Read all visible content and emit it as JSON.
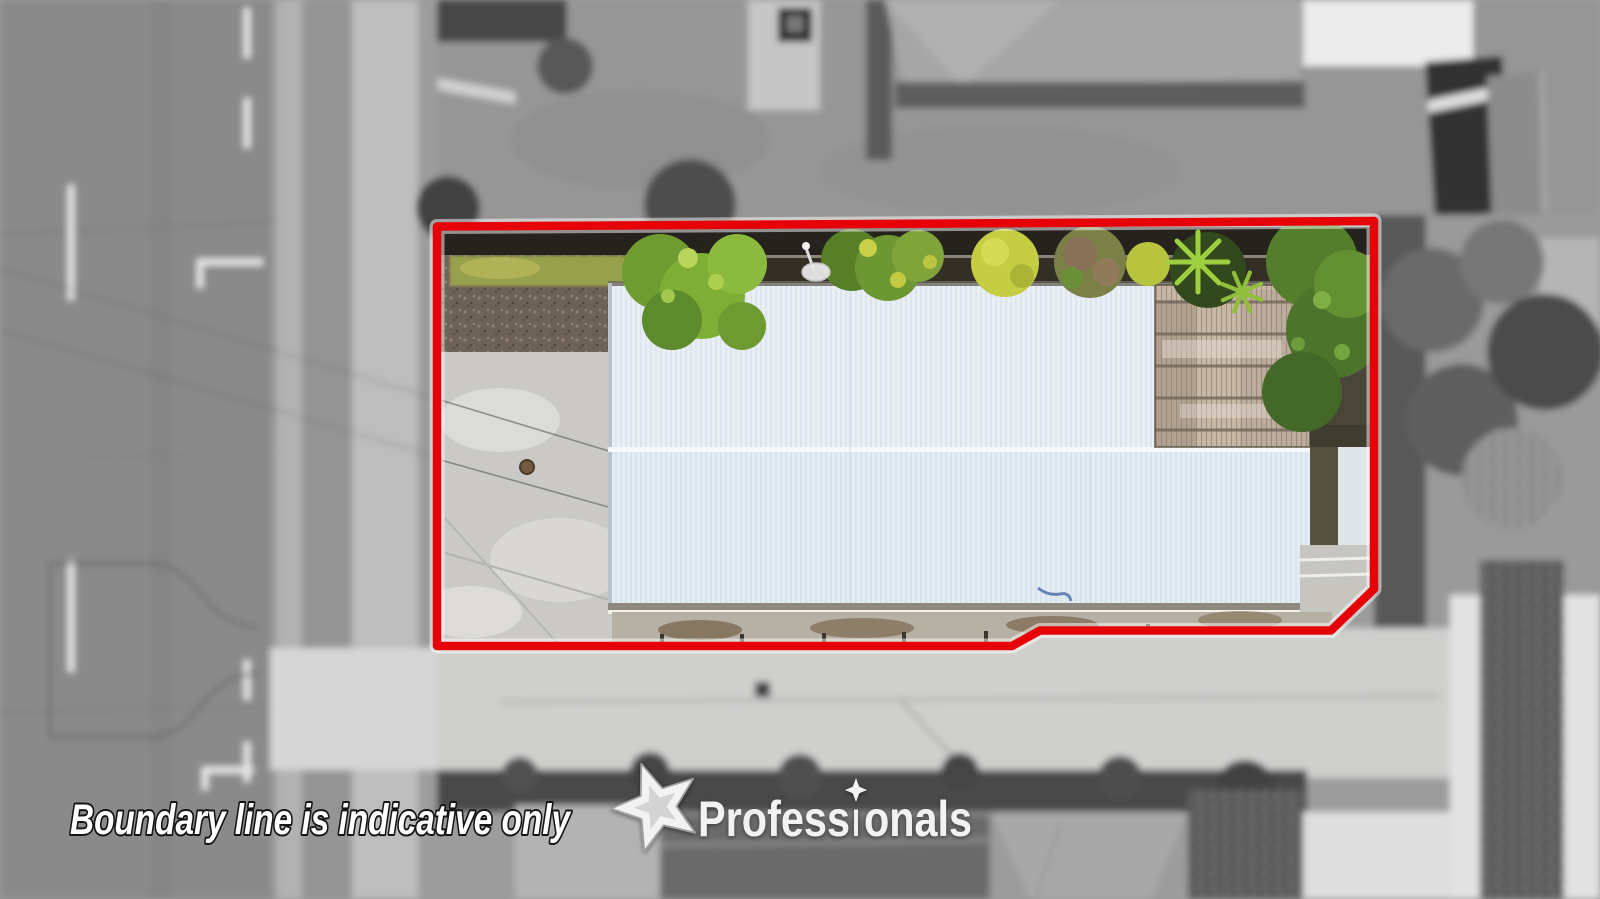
{
  "overlay": {
    "disclaimer": "Boundary line is indicative only",
    "brand": {
      "name": "Professionals",
      "segments": {
        "pre": "Profess",
        "dotless_i": "ı",
        "post": "onals"
      }
    }
  },
  "colors": {
    "boundary_red": "#E60008",
    "boundary_glow": "#FFFFFF",
    "roof_blue": "#E4ECF3",
    "roof_ridge_white": "#F6F9FB",
    "pergola_tan": "#C9B7A6",
    "driveway_grey": "#CAC9C5",
    "lawn_strip_green": "#97A14B",
    "bush_green": "#6F9C30",
    "fern_green": "#9ECF3F",
    "mulch_brown": "#6E6257",
    "watermark_white": "#FFFFFF",
    "logo_white": "#F2F2F2"
  }
}
